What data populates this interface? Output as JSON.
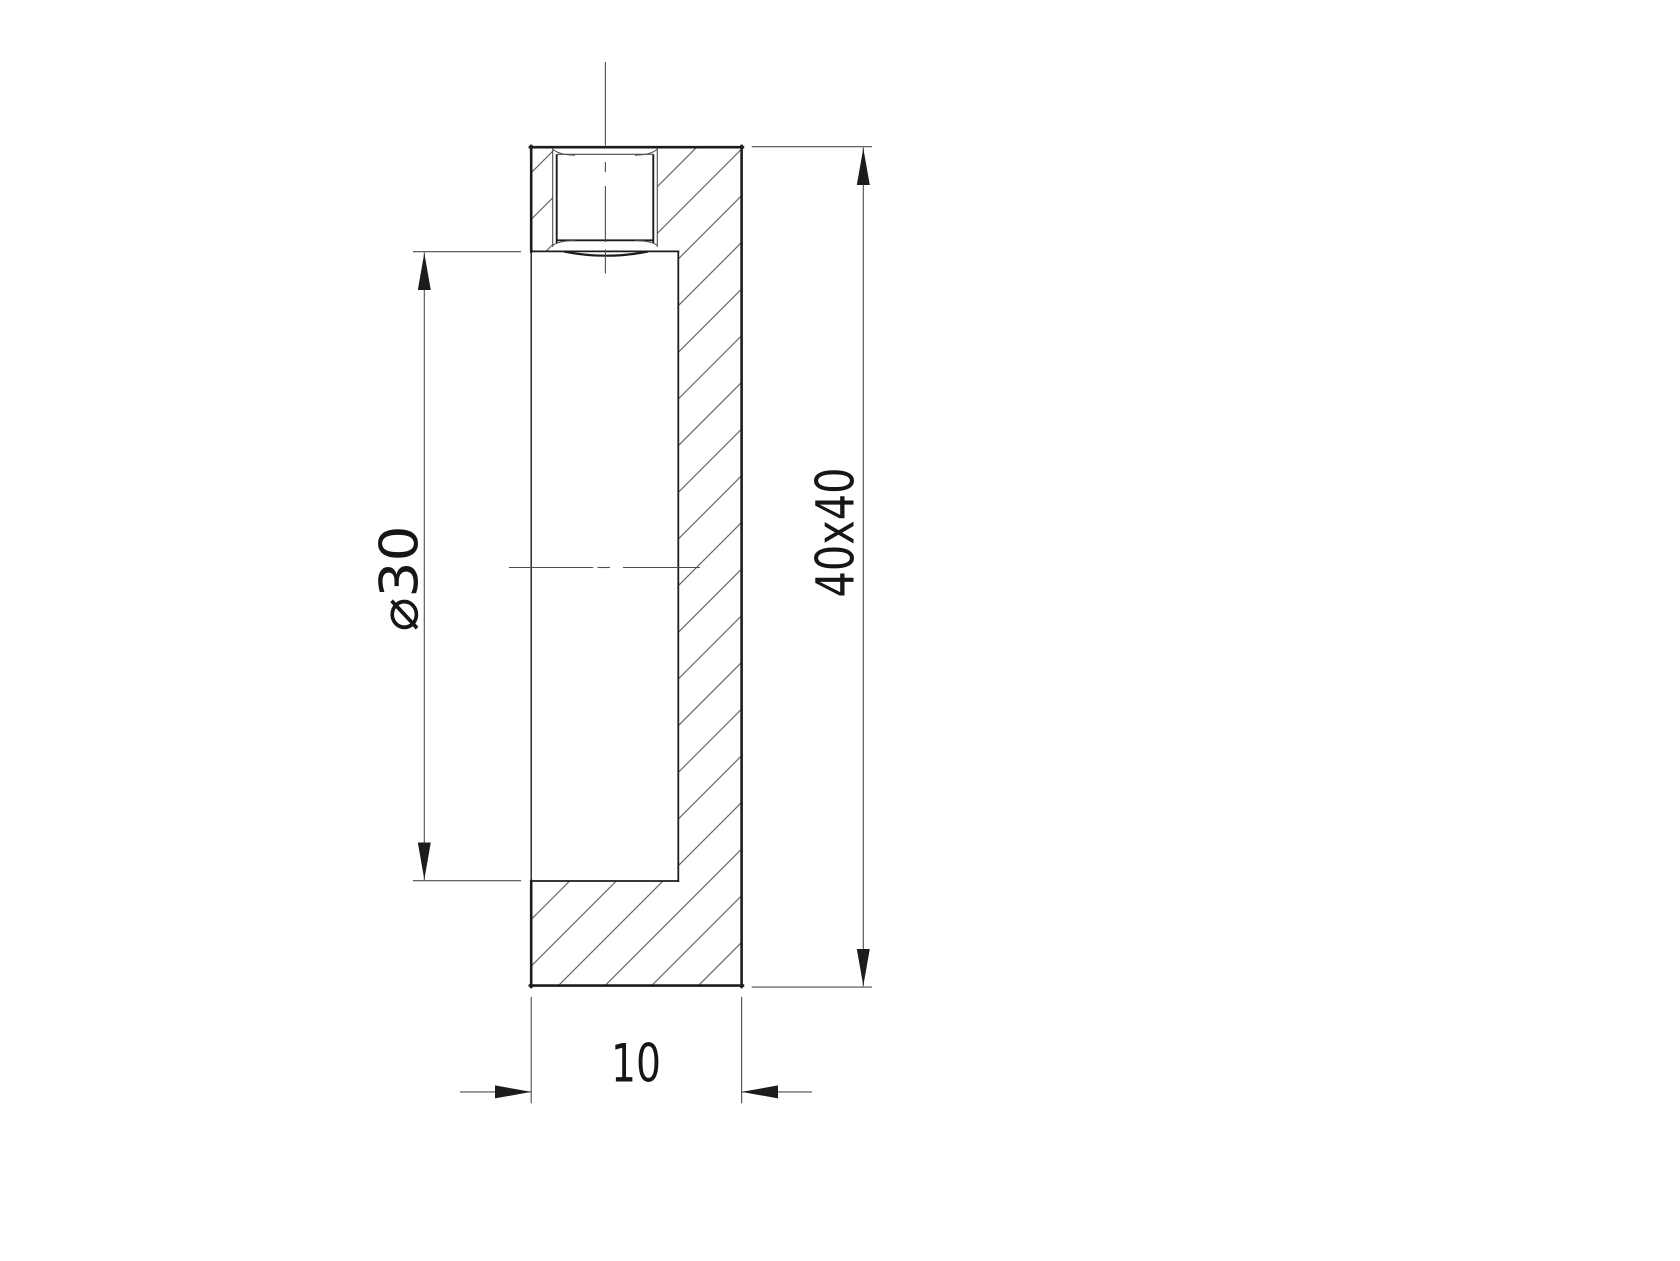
{
  "drawing": {
    "dimension_labels": {
      "bore_diameter": "⌀30",
      "overall_size": "40x40",
      "thickness": "10"
    },
    "colors": {
      "background": "#ffffff",
      "edge": "#1c1c1c",
      "thin_line": "#4d4d4d",
      "hatch_line": "#474747",
      "text": "#161616"
    }
  }
}
